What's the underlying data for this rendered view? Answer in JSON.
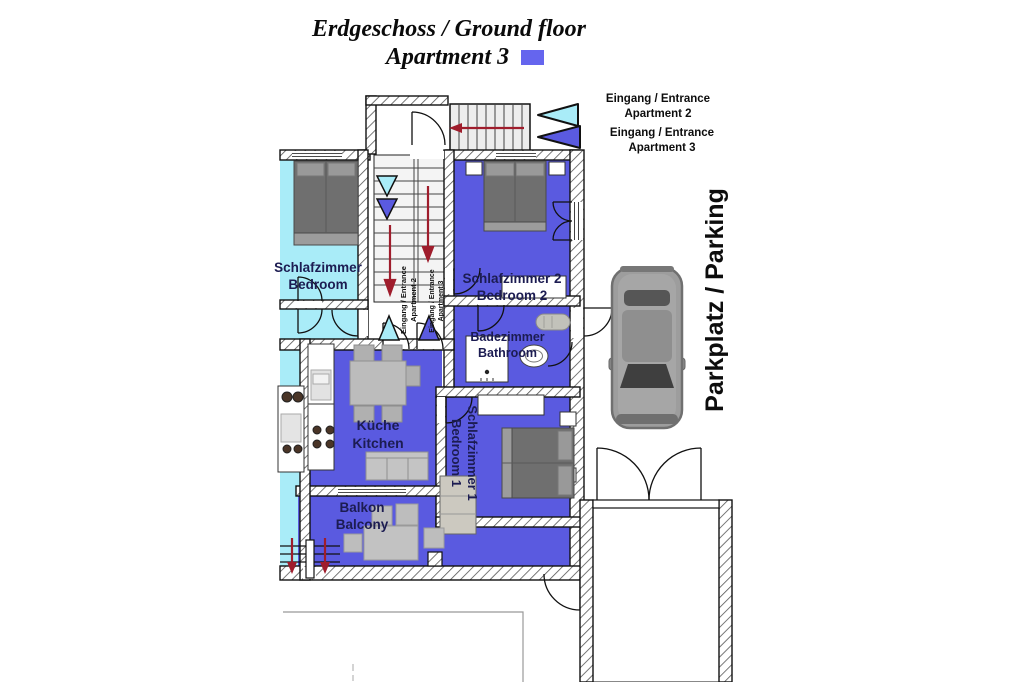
{
  "title": {
    "line1": "Erdgeschoss / Ground floor",
    "line2": "Apartment 3"
  },
  "legend": {
    "apartment3_swatch_color": "#6565ee"
  },
  "entrance_labels": {
    "apartment2": {
      "line1": "Eingang / Entrance",
      "line2": "Apartment 2"
    },
    "apartment3": {
      "line1": "Eingang / Entrance",
      "line2": "Apartment 3"
    }
  },
  "parking": {
    "label": "Parkplatz / Parking"
  },
  "rooms": {
    "bedroom_apt2": {
      "line1": "Schlafzimmer",
      "line2": "Bedroom"
    },
    "bedroom2": {
      "line1": "Schlafzimmer 2",
      "line2": "Bedroom 2"
    },
    "bathroom": {
      "line1": "Badezimmer",
      "line2": "Bathroom"
    },
    "kitchen": {
      "line1": "Küche",
      "line2": "Kitchen"
    },
    "bedroom1": {
      "line1": "Schlafzimmer 1",
      "line2": "Bedroom 1"
    },
    "balcony": {
      "line1": "Balkon",
      "line2": "Balcony"
    }
  },
  "hall_labels": {
    "apartment2": {
      "line1": "Eingang / Entrance",
      "line2": "Apartment 2"
    },
    "apartment3": {
      "line1": "Eingang / Entrance",
      "line2": "Apartment 3"
    }
  },
  "colors": {
    "apartment3_fill": "#5a5ae0",
    "apartment2_fill": "#a9ecf8",
    "arrow_red": "#9f1d2c"
  }
}
